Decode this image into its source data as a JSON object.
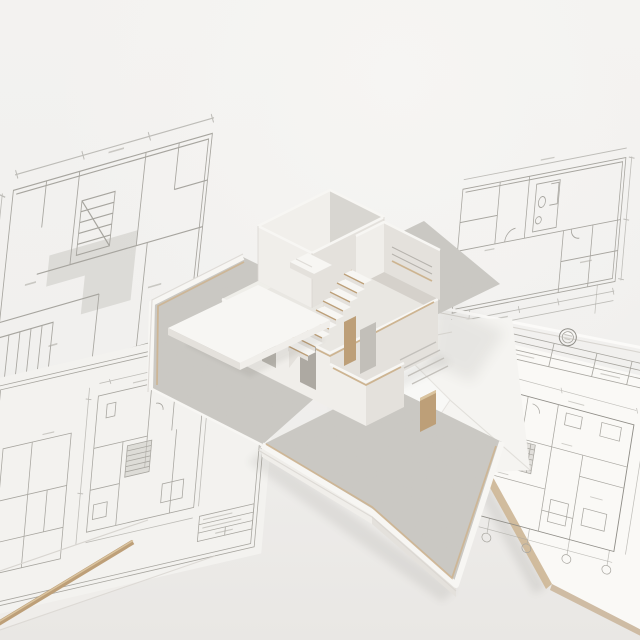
{
  "page": {
    "title": "White architectural scale model of a two-story house standing on a concrete base, surrounded by floor-plan blueprint sheets on a white table"
  },
  "palette": {
    "bg": "#f2f1ef",
    "bg-bottom": "#e9e7e4",
    "sheet": "#f3f2ef",
    "sheet-under": "#efedea",
    "board": "#faf9f6",
    "line": "#a7a59f",
    "line-dark": "#8f8d87",
    "shade": "#c8c6c0",
    "concrete": "#d3d1cc",
    "concrete-dark": "#c3c0bb",
    "model-white": "#f7f6f3",
    "face-lit": "#f0eeea",
    "face-shade": "#e4e1dc",
    "face-dark": "#cfccc6",
    "floor": "#e9e7e2",
    "edge-line": "#d8d5d0",
    "wood": "#bd9f78",
    "wood-light": "#cdb491",
    "wood-bright": "#dac49f"
  },
  "scene": {
    "description": "Top-down three-quarter view of a cutaway white model house (open roof, visible bedroom, kitchen, staircase with wooden treads, canopy and courtyards) placed over architectural drawings",
    "sheets": [
      {
        "id": "sheet-top-left",
        "label": "blueprint floor plan sheet, top left, laid flat"
      },
      {
        "id": "sheet-bottom-left",
        "label": "blueprint floor plan sheet with border and title block, bottom left"
      },
      {
        "id": "sheet-top-right",
        "label": "blueprint floor plan sheet, top right"
      },
      {
        "id": "board-bottom-right",
        "label": "presentation board with floor plan, stamp seal and title strip, bottom right"
      },
      {
        "id": "tracing-sheet",
        "label": "loose creased tracing sheet between model and board"
      }
    ],
    "model": {
      "label": "two-story white architectural scale model",
      "parts": [
        {
          "id": "base",
          "label": "concrete model base"
        },
        {
          "id": "terrace",
          "label": "left terrace with white rim"
        },
        {
          "id": "courtyard",
          "label": "front courtyard tray"
        },
        {
          "id": "bedroom",
          "label": "upper-floor bedroom with bed"
        },
        {
          "id": "kitchen",
          "label": "kitchen volume with shelving"
        },
        {
          "id": "staircase",
          "label": "staircase with wooden tread edges"
        },
        {
          "id": "canopy",
          "label": "flat canopy slab"
        },
        {
          "id": "annex",
          "label": "front annex room"
        }
      ]
    },
    "props": [
      {
        "id": "wood-strip",
        "label": "thin wooden strip lying across the lower-left sheets"
      },
      {
        "id": "wood-block",
        "label": "small wooden offcut beside the model"
      }
    ]
  }
}
